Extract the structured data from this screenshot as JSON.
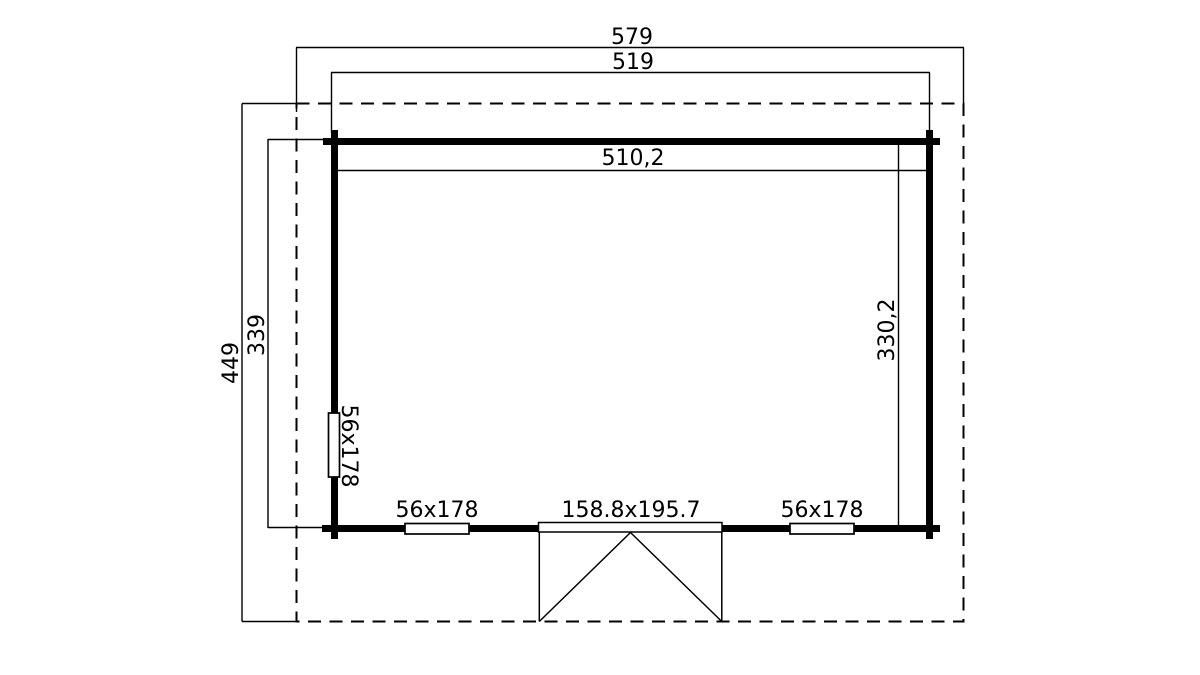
{
  "drawing": {
    "type": "floor-plan",
    "colors": {
      "line": "#000000",
      "background": "#ffffff"
    },
    "dimensions": {
      "overall_width": "579",
      "wall_outer_width": "519",
      "interior_width": "510,2",
      "overall_depth": "449",
      "wall_outer_depth": "339",
      "interior_depth": "330,2"
    },
    "openings": {
      "left_window": "56x178",
      "bottom_window_1": "56x178",
      "door": "158.8x195.7",
      "bottom_window_2": "56x178"
    }
  }
}
